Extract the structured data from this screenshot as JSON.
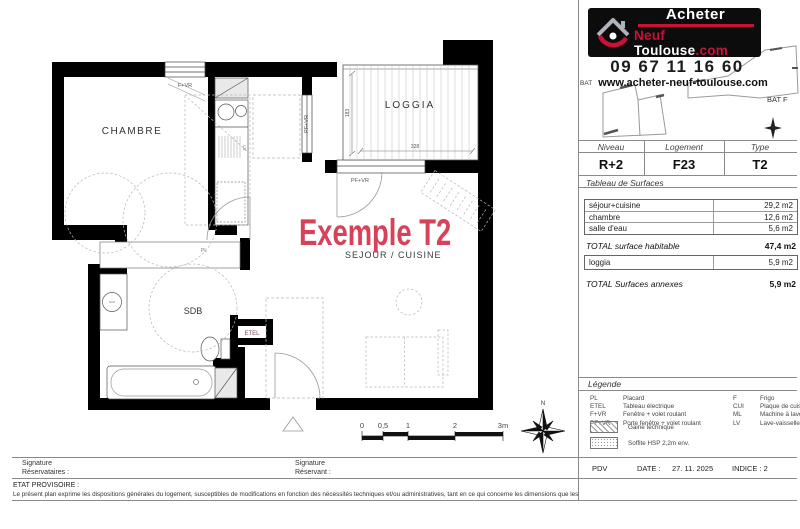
{
  "colors": {
    "accent_red": "#d8415a",
    "brand_red": "#c81236"
  },
  "logo": {
    "line1": "Acheter",
    "neuf": "Neuf",
    "toulouse": "Toulouse",
    "dotcom": ".com"
  },
  "contact": {
    "phone": "09 67 11 16 60",
    "website": "www.acheter-neuf-toulouse.com"
  },
  "site": {
    "bat_left": "BAT",
    "bat_right": "BAT F"
  },
  "unit": {
    "niveau_label": "Niveau",
    "logement_label": "Logement",
    "type_label": "Type",
    "niveau": "R+2",
    "logement": "F23",
    "type": "T2"
  },
  "surfaces": {
    "section_title": "Tableau de Surfaces",
    "rows": [
      {
        "label": "séjour+cuisine",
        "value": "29,2 m2"
      },
      {
        "label": "chambre",
        "value": "12,6 m2"
      },
      {
        "label": "salle d'eau",
        "value": "5,6 m2"
      }
    ],
    "total_habitable_label": "TOTAL surface habitable",
    "total_habitable_value": "47,4 m2",
    "annex_rows": [
      {
        "label": "loggia",
        "value": "5,9 m2"
      }
    ],
    "total_annex_label": "TOTAL Surfaces annexes",
    "total_annex_value": "5,9 m2"
  },
  "legend": {
    "title": "Légende",
    "items_left": [
      {
        "abbr": "PL",
        "label": "Placard"
      },
      {
        "abbr": "ETEL",
        "label": "Tableau électrique"
      },
      {
        "abbr": "F+VR",
        "label": "Fenêtre + volet roulant"
      },
      {
        "abbr": "PF+VR",
        "label": "Porte fenêtre + volet roulant"
      }
    ],
    "items_right": [
      {
        "abbr": "F",
        "label": "Frigo"
      },
      {
        "abbr": "CUI",
        "label": "Plaque de cuisson"
      },
      {
        "abbr": "ML",
        "label": "Machine à laver"
      },
      {
        "abbr": "LV",
        "label": "Lave-vaisselle"
      }
    ],
    "swatch_hatch_label": "Gaine technique",
    "swatch_dots_label": "Soffite HSP 2,2m env."
  },
  "footer": {
    "pdv": "PDV",
    "date_label": "DATE :",
    "date": "27. 11. 2025",
    "indice": "INDICE : 2"
  },
  "signatures": {
    "left_line1": "Signature",
    "left_line2": "Réservataires :",
    "right_line1": "Signature",
    "right_line2": "Réservant :"
  },
  "disclaimer": {
    "title": "ETAT PROVISOIRE :",
    "text": "Le présent plan exprime les dispositions générales du logement, susceptibles de modifications en fonction des nécessités techniques et/ou administratives, tant en  ce qui concerne les dimensions que les équipements."
  },
  "plan": {
    "title_red": "Exemple T2",
    "subtitle": "SEJOUR / CUISINE",
    "rooms": {
      "chambre": "CHAMBRE",
      "loggia": "LOGGIA",
      "sdb": "SDB"
    },
    "labels": {
      "fvr": "F+VR",
      "pfvr_v": "PF+VR",
      "pfvr_h": "PF+VR",
      "pl": "PL",
      "etel": "ETEL",
      "lv": "LV",
      "dim_w": "328",
      "dim_h": "183",
      "north": "N"
    },
    "scale": {
      "t0": "0",
      "t05": "0,5",
      "t1": "1",
      "t2": "2",
      "t3": "3m"
    }
  }
}
